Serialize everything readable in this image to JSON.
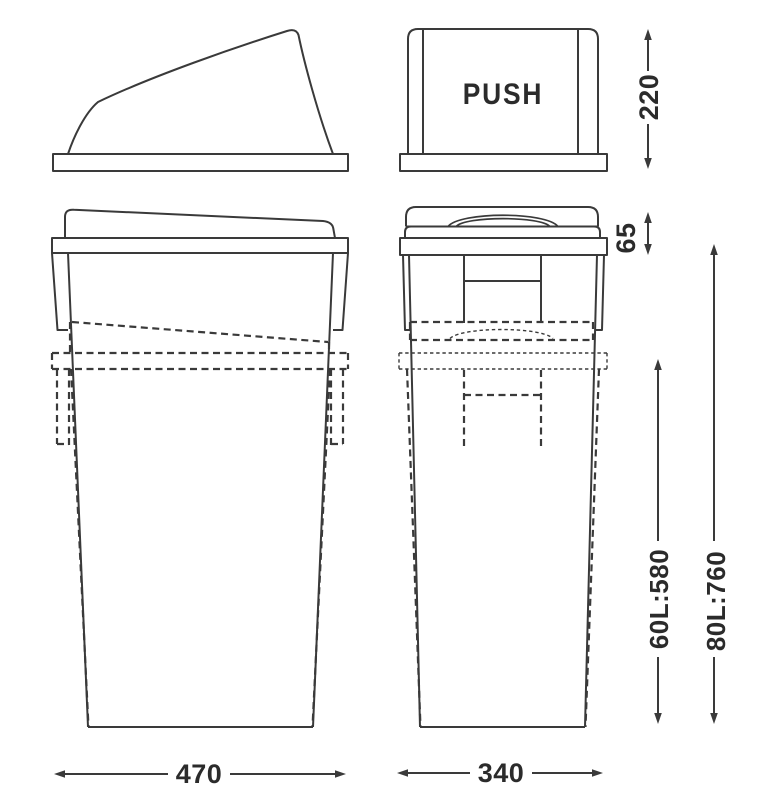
{
  "diagram": {
    "push_label": "PUSH",
    "dimensions": {
      "lid_height": "220",
      "collar_height": "65",
      "height_60l": "60L:580",
      "height_80l": "80L:760",
      "width_side_view": "470",
      "width_front_view": "340"
    },
    "colors": {
      "line": "#3a3a3a",
      "text": "#2b2b2b",
      "background": "#ffffff"
    }
  }
}
